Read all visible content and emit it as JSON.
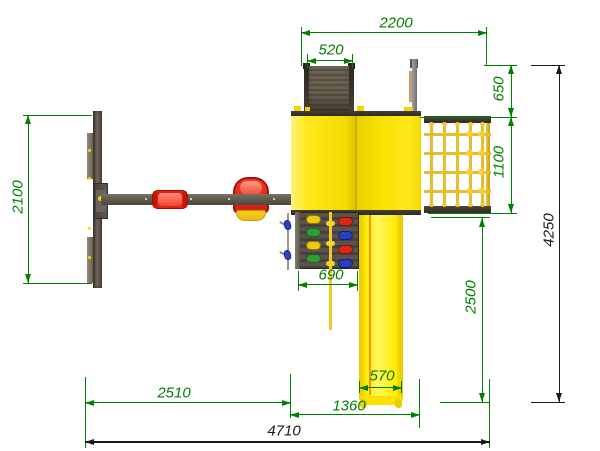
{
  "drawing": {
    "view": "top view",
    "colors": {
      "dimension_green": "#008000",
      "dimension_black": "#1a1a1a",
      "platform_yellow": "#f7e000",
      "slide_yellow": "#ffe900",
      "wood_dark": "#4a443c",
      "seat_red": "#e02415",
      "rope_yellow": "#e6bd2c",
      "hold_green": "#2f9c35",
      "hold_blue": "#2a3ec2"
    },
    "dimensions": [
      {
        "id": "ladder-span",
        "value": "2200",
        "orientation": "horizontal"
      },
      {
        "id": "ladder-width",
        "value": "520",
        "orientation": "horizontal"
      },
      {
        "id": "ramp-depth",
        "value": "650",
        "orientation": "vertical"
      },
      {
        "id": "net-depth",
        "value": "1100",
        "orientation": "vertical"
      },
      {
        "id": "swing-frame-width",
        "value": "2100",
        "orientation": "vertical"
      },
      {
        "id": "climb-wall-width",
        "value": "690",
        "orientation": "horizontal"
      },
      {
        "id": "slide-run",
        "value": "2500",
        "orientation": "vertical"
      },
      {
        "id": "overall-depth",
        "value": "4250",
        "orientation": "vertical"
      },
      {
        "id": "swing-bay-width",
        "value": "2510",
        "orientation": "horizontal"
      },
      {
        "id": "slide-width",
        "value": "570",
        "orientation": "horizontal"
      },
      {
        "id": "platform-width",
        "value": "1360",
        "orientation": "horizontal"
      },
      {
        "id": "overall-width",
        "value": "4710",
        "orientation": "horizontal"
      }
    ],
    "components": [
      "swing-frame",
      "swing-beam",
      "flat-swing-seat",
      "baby-swing-seat",
      "climbing-ramp",
      "platform",
      "flag-pole",
      "climbing-net",
      "climbing-wall",
      "climb-rope",
      "slide"
    ]
  }
}
